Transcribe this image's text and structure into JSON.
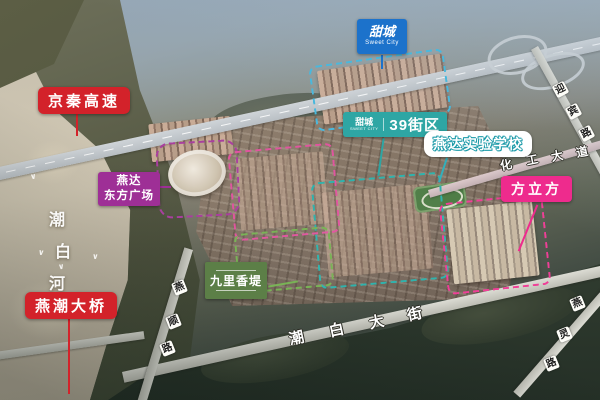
{
  "labels": {
    "expressway": {
      "text": "京秦高速",
      "color": "#d3222a"
    },
    "bridge": {
      "text": "燕潮大桥",
      "color": "#d3222a"
    },
    "plaza": {
      "line1": "燕达",
      "line2": "东方广场",
      "color": "#9e2f96"
    },
    "sweet_city": {
      "cn": "甜城",
      "en": "Sweet City",
      "color": "#1c72cb"
    },
    "block39": {
      "brand_cn": "甜城",
      "brand_en": "SWEET CITY",
      "text": "39街区",
      "color": "#2ea6a4"
    },
    "school": {
      "text": "燕达实验学校",
      "color": "#1b9aa8"
    },
    "cube": {
      "text": "方立方",
      "color": "#ee2b8d"
    },
    "jiuli": {
      "text": "九里香堤",
      "color": "#5c7f47"
    }
  },
  "roads": {
    "river": {
      "name": "潮白河",
      "chars": [
        "潮",
        "白",
        "河"
      ]
    },
    "yanshun": {
      "name": "燕顺路",
      "chars": [
        "燕",
        "顺",
        "路"
      ]
    },
    "chaobai_avenue": {
      "name": "潮白大街",
      "chars": [
        "潮",
        "白",
        "大",
        "街"
      ]
    },
    "huagong_avenue": {
      "name": "化工大道",
      "chars": [
        "化",
        "工",
        "大",
        "道"
      ]
    },
    "yanling": {
      "name": "燕灵路",
      "chars": [
        "燕",
        "灵",
        "路"
      ]
    },
    "yingbin": {
      "name": "迎宾路",
      "chars": [
        "迎",
        "宾",
        "路"
      ]
    }
  },
  "zones": [
    {
      "name": "sweet-city-north",
      "outline_color": "#49b8dd"
    },
    {
      "name": "oriental-plaza",
      "outline_color": "#a93f9f"
    },
    {
      "name": "central-west",
      "outline_color": "#e0559f"
    },
    {
      "name": "block39",
      "outline_color": "#2fb3ad"
    },
    {
      "name": "jiuli-xiangdi",
      "outline_color": "#79b356"
    },
    {
      "name": "fang-cube",
      "outline_color": "#ef3f97"
    }
  ]
}
